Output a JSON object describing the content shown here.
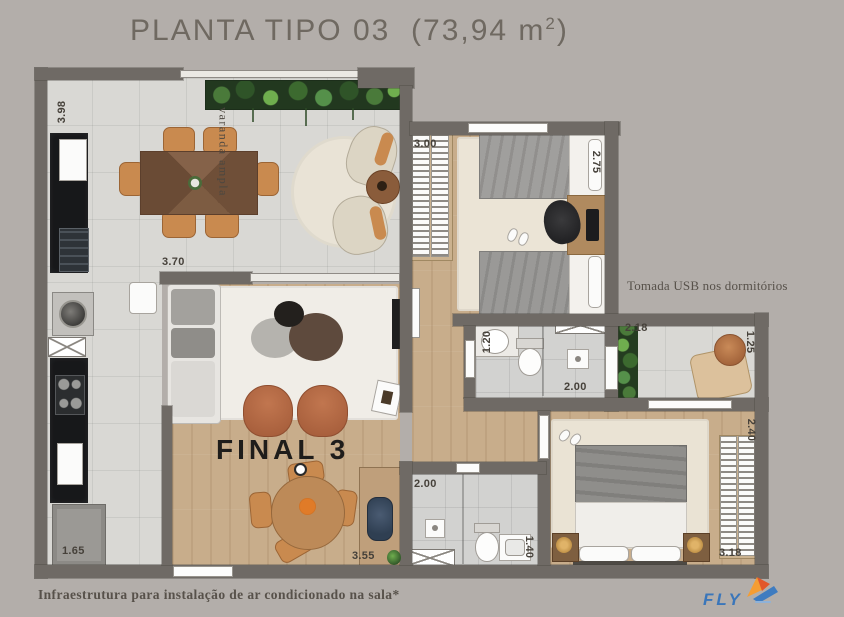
{
  "title": {
    "name": "PLANTA TIPO 03",
    "area_prefix": "(73,94 m",
    "area_sup": "2",
    "area_suffix": ")"
  },
  "plan": {
    "unit_label": "FINAL 3",
    "balcony_label": "varanda ampla",
    "usb_note": "Tomada USB nos dormitórios",
    "dims": {
      "kitchen_depth": "3.98",
      "living_width": "3.70",
      "bedroom1_width": "3.00",
      "bedroom1_depth": "2.75",
      "bath1_depth": "1.20",
      "bath1_width": "2.00",
      "balcony2_width": "2.18",
      "balcony2_depth": "1.25",
      "bedroom2_depth": "2.40",
      "kitchen_width": "1.65",
      "bath2_width": "2.00",
      "living_length": "3.55",
      "bath2_depth": "1.40",
      "bedroom2_width": "3.18"
    }
  },
  "footer": {
    "note": "Infraestrutura para instalação de ar condicionado na sala*"
  },
  "logo": {
    "text": "FLY"
  },
  "colors": {
    "background": "#b3aeaa",
    "wall": "#6f6a65",
    "tile": "#d9d8d4",
    "wood": "#c8ad8b",
    "bath": "#d2d2d0",
    "title_text": "#6f6961",
    "dim_text": "#46413a",
    "note_text": "#57514a",
    "unit_text": "#1f1d1b",
    "logo_blue": "#3a76ba"
  }
}
